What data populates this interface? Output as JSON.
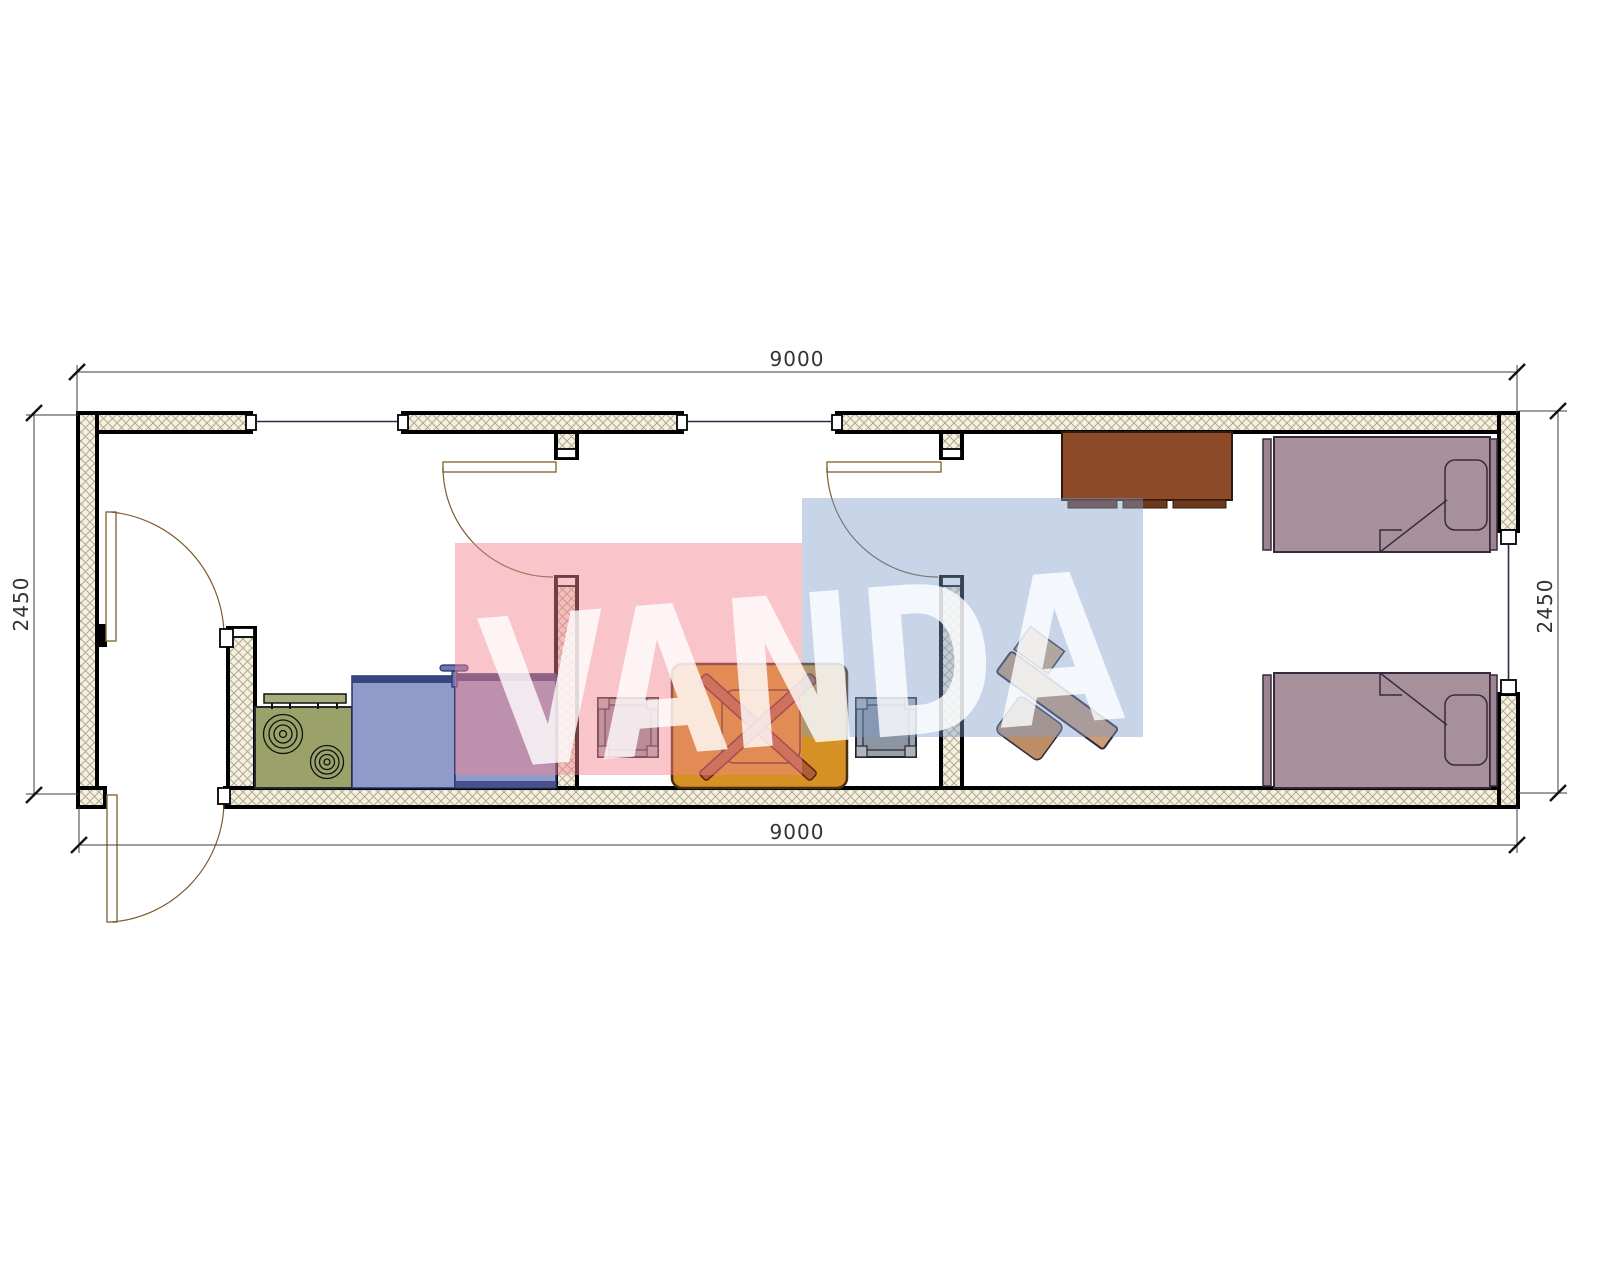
{
  "page": {
    "background": "#ffffff",
    "drawing": "container-house-floor-plan"
  },
  "dimensions": {
    "top": "9000",
    "bottom": "9000",
    "left": "2450",
    "right": "2450"
  },
  "watermark": {
    "text": "VANDA",
    "pink_block_color": "#f3848e",
    "blue_block_color": "#809ecc",
    "letter_color": "#ffffff"
  },
  "palette": {
    "wall_fill": "#f4f0e2",
    "wall_hatch_line": "#b3aa8c",
    "wall_outline": "#000000",
    "window_line": "#2a2a55",
    "door_line": "#8a6a35",
    "dimension_line": "#3c3c3c",
    "stove": "#9aa169",
    "shelf": "#a9ad7c",
    "counter": "#8f9cca",
    "counter_edge": "#39457e",
    "faucet": "#6b77ad",
    "table": "#d59123",
    "table_legs": "#b06030",
    "stool": "#99a0ab",
    "stool_inner": "#8d95a2",
    "stool_corner": "#aeb3bd",
    "bed": "#a8909b",
    "bed_rail": "#9e8490",
    "cabinet": "#8c4a28",
    "cabinet_base": "#6e3a1e",
    "desk": "#cb9c77",
    "chair": "#bd8e66",
    "chair_back": "#d8ad85"
  },
  "symbols": [
    "stove-icon",
    "range-shelf-icon",
    "kitchen-counter-icon",
    "kitchen-counter-icon",
    "faucet-icon",
    "stool-icon",
    "dining-table-icon",
    "stool-icon",
    "desk-with-chair-icon",
    "wardrobe-cabinet-icon",
    "single-bed-icon",
    "single-bed-icon",
    "door-swing-icon",
    "door-swing-icon",
    "door-swing-icon",
    "door-swing-icon",
    "window-icon",
    "window-icon",
    "window-icon"
  ]
}
